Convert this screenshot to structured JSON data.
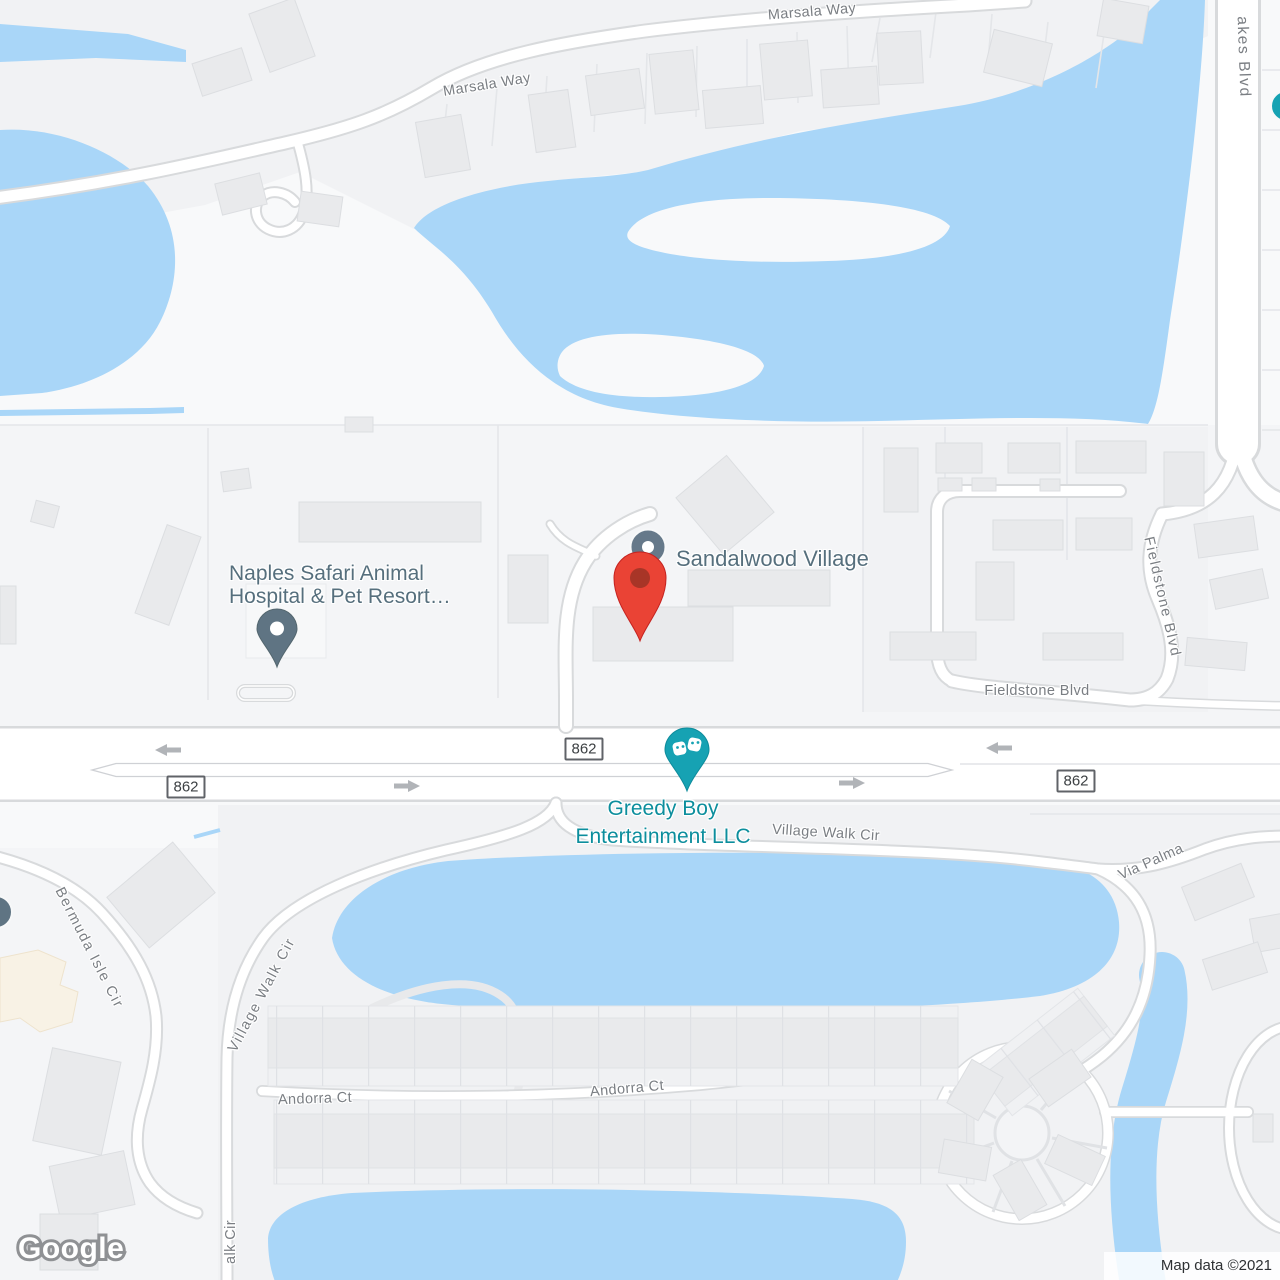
{
  "map": {
    "watermark": "Google",
    "attribution": "Map data ©2021",
    "colors": {
      "land": "#f8f9fa",
      "block": "#f1f2f4",
      "water": "#a9d6f8",
      "road_fill": "#ffffff",
      "road_casing": "#d8dadc",
      "building": "#e9eaec",
      "building_cream": "#f8f2e5",
      "street_label": "#7a7e83",
      "poi_label": "#566f7d",
      "teal_accent": "#16a2b3",
      "teal_label": "#0c8e9d",
      "red_pin": "#ea4335",
      "red_pin_inner": "#a83527",
      "slate_pin": "#5f7483",
      "arrow": "#b1b4b8",
      "shield_border": "#606368",
      "shield_text": "#3c4043"
    },
    "street_labels": [
      {
        "text": "Marsala Way"
      },
      {
        "text": "Marsala Way"
      },
      {
        "text": "akes Blvd"
      },
      {
        "text": "Fieldstone Blvd"
      },
      {
        "text": "Fieldstone Blvd"
      },
      {
        "text": "Village Walk Cir"
      },
      {
        "text": "Village Walk Cir"
      },
      {
        "text": "Via Palma"
      },
      {
        "text": "Bermuda Isle Cir"
      },
      {
        "text": "Andorra Ct"
      },
      {
        "text": "Andorra Ct"
      },
      {
        "text": "alk Cir"
      }
    ],
    "poi_labels": {
      "sandalwood": {
        "text": "Sandalwood Village"
      },
      "naples": {
        "line1": "Naples Safari Animal",
        "line2": "Hospital & Pet Resort…"
      },
      "greedy": {
        "line1": "Greedy Boy",
        "line2": "Entertainment LLC"
      }
    },
    "route_shields": [
      {
        "label": "862"
      },
      {
        "label": "862"
      },
      {
        "label": "862"
      }
    ],
    "markers": [
      {
        "name": "destination-red-pin",
        "poi": "Sandalwood Village"
      },
      {
        "name": "sandalwood-circle-marker",
        "poi": "Sandalwood Village"
      },
      {
        "name": "animal-hospital-pin",
        "poi": "Naples Safari Animal Hospital & Pet Resort"
      },
      {
        "name": "entertainment-masks-pin",
        "poi": "Greedy Boy Entertainment LLC"
      }
    ]
  }
}
